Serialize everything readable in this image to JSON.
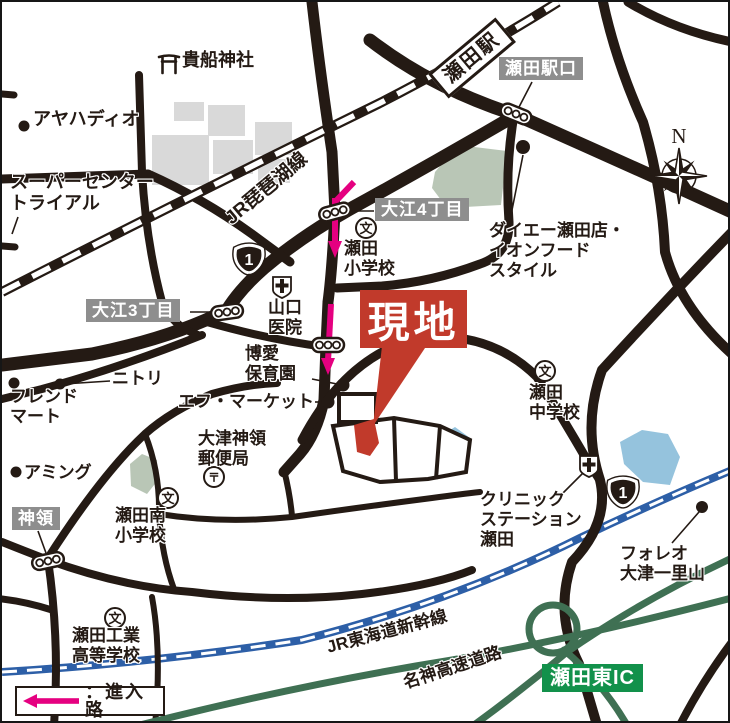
{
  "site": {
    "label": "現地"
  },
  "legend": {
    "entry_route": "：進入路"
  },
  "compass": {
    "north": "N"
  },
  "route_shields": {
    "national_route_1": "1"
  },
  "railways": {
    "seta_station": "瀬田駅",
    "biwako_line": "JR琵琶湖線",
    "shinkansen": "JR東海道新幹線"
  },
  "highways": {
    "meishin_expressway": "名神高速道路",
    "seta_higashi_ic": "瀬田東IC"
  },
  "intersections": {
    "seta_ekiguchi": "瀬田駅口",
    "oe_4chome": "大江4丁目",
    "oe_3chome": "大江3丁目",
    "shinryo": "神領"
  },
  "places": {
    "kifune_shrine": "貴船神社",
    "ayaha_dio": "アヤハディオ",
    "super_center_trial": "スーパーセンター\nトライアル",
    "daiei_aeon": "ダイエー瀬田店・\nイオンフード\nスタイル",
    "seta_elementary": "瀬田\n小学校",
    "yamaguchi_clinic": "山口\n医院",
    "hakuai_nursery": "博愛\n保育園",
    "f_market": "エフ・マーケット",
    "otsu_shinryo_post_office": "大津神領\n郵便局",
    "seta_junior_high": "瀬田\n中学校",
    "nitori": "ニトリ",
    "friend_mart": "フレンド\nマート",
    "aming": "アミング",
    "seta_minami_elementary": "瀬田南\n小学校",
    "clinic_station_seta": "クリニック\nステーション\n瀬田",
    "foleo_otsu_ichiriyama": "フォレオ\n大津一里山",
    "seta_technical_high_school": "瀬田工業\n高等学校"
  },
  "icons": {
    "school_glyph": "文",
    "post_office_glyph": "〒"
  },
  "colors": {
    "road_black": "#241a14",
    "shinkansen_blue": "#2d5fa7",
    "highway_green": "#3f7053",
    "ic_label_green": "#12914b",
    "entry_route_pink": "#e50080",
    "site_red": "#c13a2b",
    "label_gray": "#8e8e8e",
    "water_blue": "#95c3dd",
    "park_green": "#b9c6b6",
    "building_gray": "#d9d9d9"
  }
}
